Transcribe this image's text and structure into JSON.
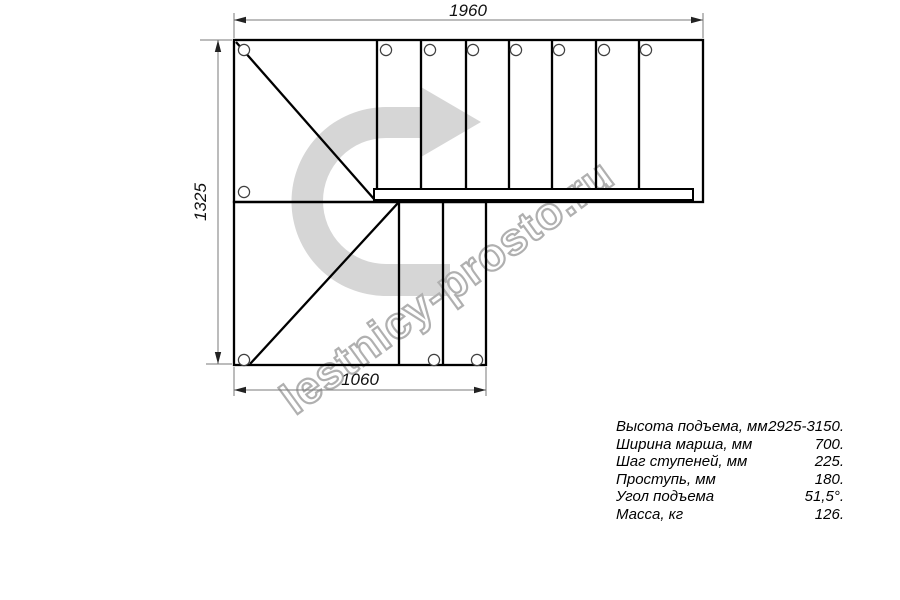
{
  "watermark": {
    "text": "lestnicy-prosto.ru"
  },
  "dimensions": {
    "top": "1960",
    "left": "1325",
    "bottom": "1060"
  },
  "specs": {
    "rows": [
      {
        "label": "Высота подъема, мм",
        "value": "2925-3150."
      },
      {
        "label": "Ширина марша, мм",
        "value": "700."
      },
      {
        "label": "Шаг ступеней, мм",
        "value": "225."
      },
      {
        "label": "Проступь, мм",
        "value": "180."
      },
      {
        "label": "Угол подъема",
        "value": "51,5°."
      },
      {
        "label": "Масса, кг",
        "value": "126."
      }
    ]
  },
  "colors": {
    "line": "#000000",
    "dimension_line": "#7a7a7a",
    "arrow_fill": "#d6d6d6",
    "watermark_outline": "#b0b0b0"
  }
}
